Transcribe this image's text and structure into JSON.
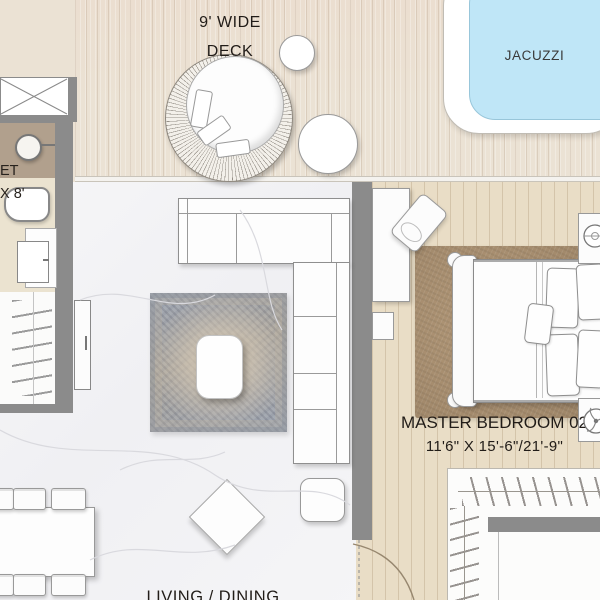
{
  "rooms": {
    "deck": {
      "label_line1": "9' WIDE",
      "label_line2": "DECK"
    },
    "jacuzzi": {
      "label": "JACUZZI"
    },
    "toilet": {
      "label_line1": "ET",
      "label_line2": "X 8'"
    },
    "master_bedroom": {
      "name": "MASTER BEDROOM 02",
      "dimensions": "11'6\" X 15'-6\"/21'-9\""
    },
    "living_dining": {
      "label": "LIVING / DINING"
    }
  },
  "icons": {
    "shaft_cross": "cross-brace-icon",
    "sink": "sink-icon",
    "toilet": "toilet-icon",
    "lamp": "lamp-icon",
    "fan": "fan-icon",
    "hangers": "hanger-rack-icon",
    "door_swing": "door-swing-arc"
  },
  "colors": {
    "wall": "#8b8b8b",
    "deck_floor": "#ebe2d4",
    "bedroom_floor": "#e9ddc6",
    "toilet_counter": "#b1a08d",
    "toilet_floor": "#ebe3d0",
    "jacuzzi_water": "#bfe6f7",
    "living_rug_edge": "#97a0ae",
    "living_rug_center": "#a9a49b",
    "bedroom_rug": "#b29878"
  }
}
